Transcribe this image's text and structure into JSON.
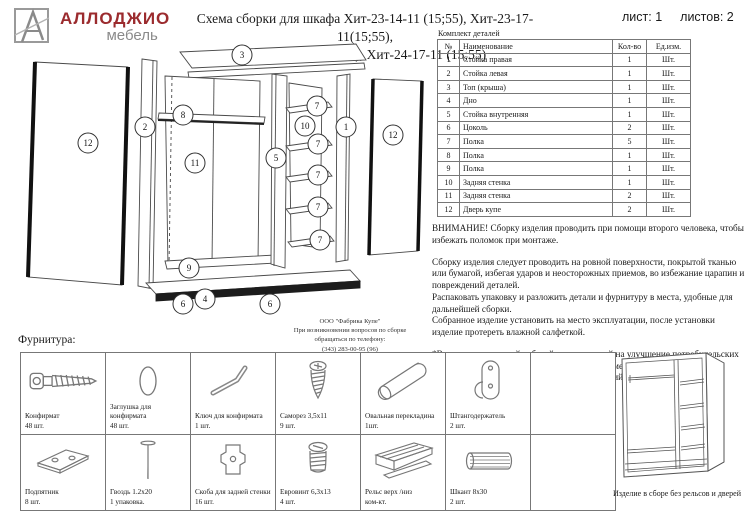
{
  "header": {
    "logo": {
      "brand": "АЛЛОДЖИО",
      "sub": "мебель"
    },
    "title_line1": "Схема сборки для шкафа Хит-23-14-11 (15;55), Хит-23-17-11(15;55),",
    "title_line2": "Хит-24-14-11(15;55), Хит-24-17-11 (15;55)",
    "sheet_label": "лист: 1",
    "sheets_label": "листов: 2"
  },
  "parts_table": {
    "title": "Комплект деталей",
    "headers": {
      "num": "№",
      "name": "Наименование",
      "qty": "Кол-во",
      "unit": "Ед.изм."
    },
    "rows": [
      {
        "num": "1",
        "name": "Стойка правая",
        "qty": "1",
        "unit": "Шт."
      },
      {
        "num": "2",
        "name": "Стойка левая",
        "qty": "1",
        "unit": "Шт."
      },
      {
        "num": "3",
        "name": "Топ (крыша)",
        "qty": "1",
        "unit": "Шт."
      },
      {
        "num": "4",
        "name": "Дно",
        "qty": "1",
        "unit": "Шт."
      },
      {
        "num": "5",
        "name": "Стойка внутренняя",
        "qty": "1",
        "unit": "Шт."
      },
      {
        "num": "6",
        "name": "Цоколь",
        "qty": "2",
        "unit": "Шт."
      },
      {
        "num": "7",
        "name": "Полка",
        "qty": "5",
        "unit": "Шт."
      },
      {
        "num": "8",
        "name": "Полка",
        "qty": "1",
        "unit": "Шт."
      },
      {
        "num": "9",
        "name": "Полка",
        "qty": "1",
        "unit": "Шт."
      },
      {
        "num": "10",
        "name": "Задняя стенка",
        "qty": "1",
        "unit": "Шт."
      },
      {
        "num": "11",
        "name": "Задняя стенка",
        "qty": "2",
        "unit": "Шт."
      },
      {
        "num": "12",
        "name": "Дверь купе",
        "qty": "2",
        "unit": "Шт."
      }
    ]
  },
  "notes": {
    "warning": "ВНИМАНИЕ! Сборку изделия проводить при помощи второго человека, чтобы избежать поломок при монтаже.",
    "p1": "Сборку изделия следует проводить на ровной поверхности, покрытой тканью или бумагой, избегая ударов и неосторожных приемов, во избежание царапин и повреждений деталей.",
    "p2": "Распаковать упаковку и разложить детали и фурнитуру в места, удобные для дальнейшей сборки.",
    "p3": "Собранное изделие установить на место эксплуатации, после установки изделие протереть влажной салфеткой.",
    "p4": "*В связи с постоянной работой, направленной на улучшение потребительских свойств мебели, возможны незначительные изменения в конструкции не влияющие на функциональные качества изделий."
  },
  "contact": {
    "line1": "ООО \"Фабрика Купе\"",
    "line2": "При возникновении вопросов по сборке",
    "line3": "обращаться по телефону:",
    "line4": "(343) 283-00-95 (96)"
  },
  "diagram": {
    "callouts": [
      "12",
      "2",
      "3",
      "8",
      "11",
      "9",
      "6",
      "4",
      "6",
      "5",
      "10",
      "7",
      "7",
      "7",
      "7",
      "7",
      "1",
      "12"
    ]
  },
  "hardware": {
    "title": "Фурнитура:",
    "row1": [
      {
        "name": "Конфирмат",
        "qty": "48 шт."
      },
      {
        "name": "Заглушка для конфирмата",
        "qty": "48 шт."
      },
      {
        "name": "Ключ для конфирмата",
        "qty": "1 шт."
      },
      {
        "name": "Саморез 3,5х11",
        "qty": "9 шт."
      },
      {
        "name": "Овальная перекладина",
        "qty": "1шт."
      },
      {
        "name": "Штангодержатель",
        "qty": "2 шт."
      }
    ],
    "row2": [
      {
        "name": "Подпятник",
        "qty": "8 шт."
      },
      {
        "name": "Гвоздь 1.2х20",
        "qty": "1 упаковка."
      },
      {
        "name": "Скоба для задней стенки",
        "qty": "16 шт."
      },
      {
        "name": "Евровинт 6,3х13",
        "qty": "4 шт."
      },
      {
        "name": "Рельс верх /низ",
        "qty": "ком-кт."
      },
      {
        "name": "Шкант 8х30",
        "qty": "2 шт."
      }
    ]
  },
  "assembled": {
    "caption": "Изделие в сборе без рельсов и дверей"
  }
}
